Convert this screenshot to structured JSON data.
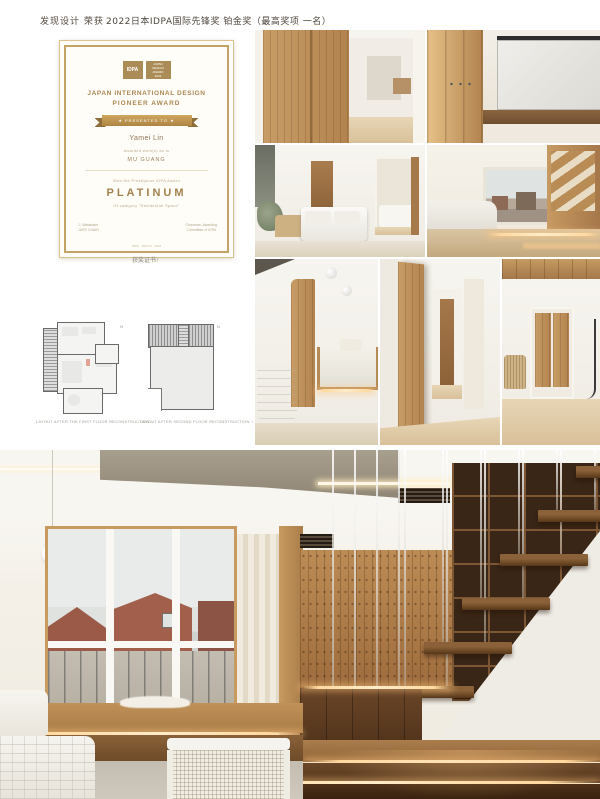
{
  "header": {
    "brand": "发现设计 荣获",
    "award_line": "2022日本IDPA国际先锋奖 铂金奖（最高奖项 一名）"
  },
  "certificate": {
    "logo_left": "IDPA",
    "logo_right_l1": "JAPAN",
    "logo_right_l2": "DESIGN",
    "logo_right_l3": "AWARD",
    "logo_right_l4": "2022",
    "title1": "JAPAN INTERNATIONAL DESIGN",
    "title2": "PIONEER AWARD",
    "ribbon": "★   PRESENTED TO   ★",
    "recipient": "Yamei Lin",
    "work_intro": "Awarded work(s) as to",
    "work_title": "MU GUANG",
    "award_intro": "Won the Prestigious IDPA Award",
    "level": "PLATINUM",
    "category": "Of category \"Residential Space\"",
    "sign_left_1": "J. Watanabe",
    "sign_left_2": "JURY CHAIR",
    "sign_right_1": "Chairman, Awarding",
    "sign_right_2": "Committee of IDPA",
    "footer": "IDPA · TOKYO · 2022",
    "caption": "获奖证书↑"
  },
  "floorplans": {
    "marker_left": "N",
    "marker_right": "N",
    "caption_left": "LAYOUT AFTER THE FIRST FLOOR RECONSTRUCTION ↑",
    "caption_right": "LAYOUT AFTER SECOND FLOOR RECONSTRUCTION ↑"
  },
  "colors": {
    "gold": "#ab8b56",
    "wood": "#b98a54",
    "led_glow": "#ffd9a0",
    "page_bg": "#ffffff"
  }
}
